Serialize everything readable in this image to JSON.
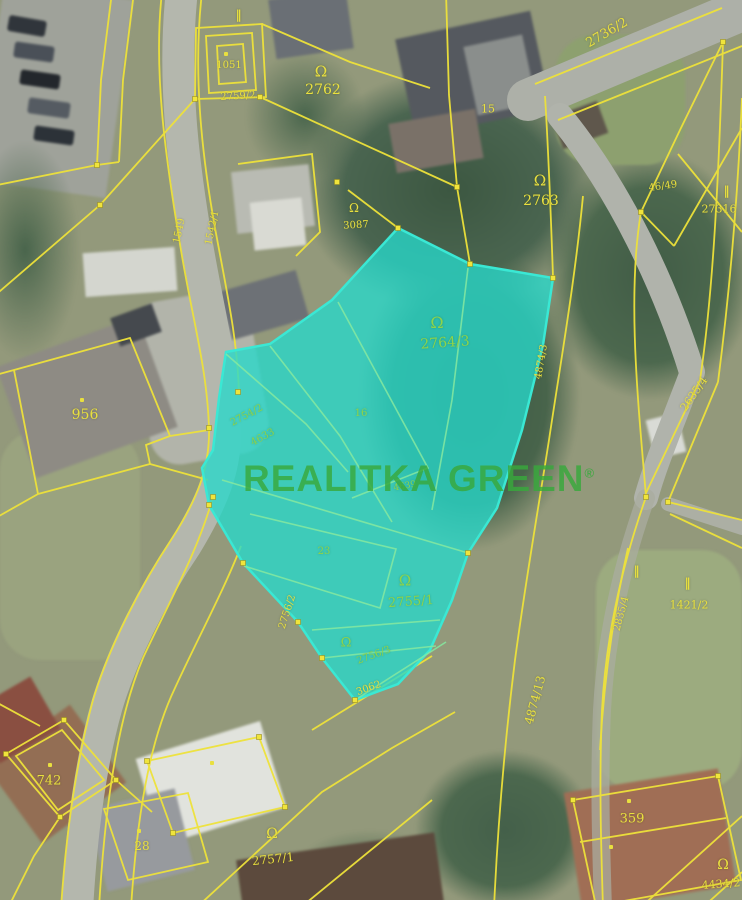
{
  "map": {
    "size": {
      "width": 742,
      "height": 900
    },
    "type": "cadastral-aerial-map",
    "watermark": {
      "text": "REALITKA GREEN",
      "reg": "®"
    },
    "colors": {
      "boundary_yellow": "#eee23a",
      "label_yellow": "#e9e03f",
      "highlight_fill": "#26d8ca",
      "highlight_edge": "#3ae8d4",
      "inner_line_green": "#86e9a0",
      "label_green": "#8ed44a",
      "watermark_green": "#38a93c"
    },
    "highlighted_parcel": "2764/3",
    "labels": [
      {
        "k": "tick",
        "t": "‖",
        "x": 239,
        "y": 15,
        "s": 12,
        "c": "y"
      },
      {
        "k": "dot",
        "x": 226,
        "y": 54
      },
      {
        "k": "num",
        "t": "1051",
        "x": 229,
        "y": 66,
        "s": 10,
        "c": "y"
      },
      {
        "k": "num",
        "t": "2759/2",
        "x": 238,
        "y": 97,
        "s": 10,
        "c": "y",
        "r": -3
      },
      {
        "k": "sym",
        "t": "Ω",
        "x": 321,
        "y": 72,
        "s": 15,
        "c": "y"
      },
      {
        "k": "num",
        "t": "2762",
        "x": 323,
        "y": 90,
        "s": 14,
        "c": "y"
      },
      {
        "k": "num",
        "t": "15",
        "x": 488,
        "y": 109,
        "s": 11,
        "c": "y"
      },
      {
        "k": "num",
        "t": "2736/2",
        "x": 607,
        "y": 33,
        "s": 13,
        "c": "y",
        "r": -30
      },
      {
        "k": "sym",
        "t": "Ω",
        "x": 540,
        "y": 181,
        "s": 15,
        "c": "y"
      },
      {
        "k": "num",
        "t": "2763",
        "x": 541,
        "y": 201,
        "s": 14,
        "c": "y"
      },
      {
        "k": "sym",
        "t": "Ω",
        "x": 354,
        "y": 208,
        "s": 12,
        "c": "y"
      },
      {
        "k": "num",
        "t": "3087",
        "x": 356,
        "y": 226,
        "s": 10,
        "c": "y",
        "r": -3
      },
      {
        "k": "num",
        "t": "46/49",
        "x": 663,
        "y": 187,
        "s": 10,
        "c": "y",
        "r": -8
      },
      {
        "k": "tick",
        "t": "‖",
        "x": 727,
        "y": 191,
        "s": 12,
        "c": "y"
      },
      {
        "k": "num",
        "t": "27316",
        "x": 719,
        "y": 209,
        "s": 11,
        "c": "y"
      },
      {
        "k": "num",
        "t": "1549",
        "x": 180,
        "y": 231,
        "s": 10,
        "c": "y",
        "r": -78
      },
      {
        "k": "num",
        "t": "1542/1",
        "x": 213,
        "y": 228,
        "s": 10,
        "c": "y",
        "r": -78
      },
      {
        "k": "sym",
        "t": "Ω",
        "x": 437,
        "y": 323,
        "s": 16,
        "c": "g"
      },
      {
        "k": "num",
        "t": "2764/3",
        "x": 445,
        "y": 343,
        "s": 14,
        "c": "g",
        "r": -4
      },
      {
        "k": "dot",
        "x": 82,
        "y": 400
      },
      {
        "k": "num",
        "t": "956",
        "x": 85,
        "y": 415,
        "s": 14,
        "c": "y"
      },
      {
        "k": "num",
        "t": "2754/2",
        "x": 247,
        "y": 416,
        "s": 10,
        "c": "g",
        "r": -28
      },
      {
        "k": "num",
        "t": "4633",
        "x": 263,
        "y": 438,
        "s": 10,
        "c": "g",
        "r": -28
      },
      {
        "k": "num",
        "t": "16",
        "x": 361,
        "y": 414,
        "s": 10,
        "c": "g"
      },
      {
        "k": "num",
        "t": "4639",
        "x": 405,
        "y": 487,
        "s": 9,
        "c": "g",
        "r": -10
      },
      {
        "k": "num",
        "t": "23",
        "x": 324,
        "y": 552,
        "s": 10,
        "c": "g"
      },
      {
        "k": "sym",
        "t": "Ω",
        "x": 405,
        "y": 581,
        "s": 15,
        "c": "g"
      },
      {
        "k": "num",
        "t": "2755/1",
        "x": 411,
        "y": 602,
        "s": 13,
        "c": "g",
        "r": -4
      },
      {
        "k": "num",
        "t": "2756/2",
        "x": 288,
        "y": 612,
        "s": 10,
        "c": "y",
        "r": -72
      },
      {
        "k": "sym",
        "t": "Ω",
        "x": 346,
        "y": 643,
        "s": 13,
        "c": "g"
      },
      {
        "k": "num",
        "t": "2756/3",
        "x": 374,
        "y": 656,
        "s": 10,
        "c": "g",
        "r": -20
      },
      {
        "k": "num",
        "t": "3062",
        "x": 369,
        "y": 689,
        "s": 10,
        "c": "y",
        "r": -20
      },
      {
        "k": "num",
        "t": "4874/3",
        "x": 542,
        "y": 362,
        "s": 10,
        "c": "y",
        "r": -80
      },
      {
        "k": "num",
        "t": "4874/13",
        "x": 535,
        "y": 700,
        "s": 12,
        "c": "y",
        "r": -75
      },
      {
        "k": "num",
        "t": "2635/4",
        "x": 694,
        "y": 394,
        "s": 11,
        "c": "y",
        "r": -55
      },
      {
        "k": "tick",
        "t": "‖",
        "x": 637,
        "y": 571,
        "s": 12,
        "c": "y"
      },
      {
        "k": "tick",
        "t": "‖",
        "x": 688,
        "y": 583,
        "s": 12,
        "c": "y"
      },
      {
        "k": "num",
        "t": "1421/2",
        "x": 689,
        "y": 605,
        "s": 11,
        "c": "y"
      },
      {
        "k": "num",
        "t": "2835/4",
        "x": 622,
        "y": 614,
        "s": 10,
        "c": "y",
        "r": -75
      },
      {
        "k": "dot",
        "x": 50,
        "y": 765
      },
      {
        "k": "num",
        "t": "742",
        "x": 49,
        "y": 781,
        "s": 13,
        "c": "y"
      },
      {
        "k": "dot",
        "x": 212,
        "y": 763
      },
      {
        "k": "dot",
        "x": 139,
        "y": 831
      },
      {
        "k": "num",
        "t": "28",
        "x": 142,
        "y": 846,
        "s": 12,
        "c": "y"
      },
      {
        "k": "sym",
        "t": "Ω",
        "x": 272,
        "y": 834,
        "s": 14,
        "c": "y"
      },
      {
        "k": "num",
        "t": "2757/1",
        "x": 273,
        "y": 859,
        "s": 12,
        "c": "y",
        "r": -6
      },
      {
        "k": "dot",
        "x": 629,
        "y": 801
      },
      {
        "k": "num",
        "t": "359",
        "x": 632,
        "y": 819,
        "s": 13,
        "c": "y"
      },
      {
        "k": "dot",
        "x": 611,
        "y": 847
      },
      {
        "k": "sym",
        "t": "Ω",
        "x": 723,
        "y": 865,
        "s": 14,
        "c": "y"
      },
      {
        "k": "num",
        "t": "4434/2",
        "x": 721,
        "y": 884,
        "s": 11,
        "c": "y",
        "r": -4
      }
    ]
  }
}
